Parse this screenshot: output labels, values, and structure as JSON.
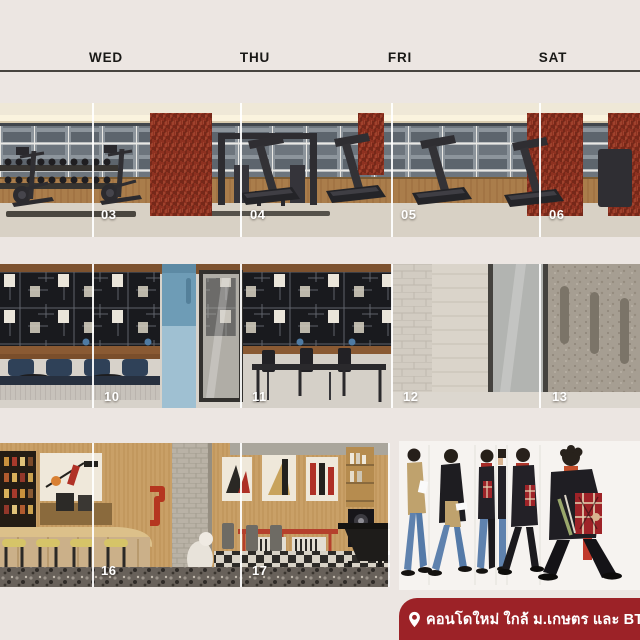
{
  "page": {
    "background_color": "#ece6e2",
    "divider_color": "#ffffff",
    "rule_color": "#47443f"
  },
  "header": {
    "days": [
      "WED",
      "THU",
      "FRI",
      "SAT"
    ]
  },
  "grid": {
    "row1": {
      "scene": "fitness-gym-rendering",
      "dates": [
        "03",
        "04",
        "05",
        "06"
      ]
    },
    "row2": {
      "scene": "co-working-lounge-rendering",
      "dates": [
        "10",
        "11",
        "12",
        "13"
      ]
    },
    "row3": {
      "scene": "cafe-pantry-rendering",
      "dates": [
        "16",
        "17"
      ]
    }
  },
  "illustration": {
    "name": "walking-man-photo-collage",
    "slices": 6
  },
  "banner": {
    "icon": "location-pin-icon",
    "text": "คอนโดใหม่ ใกล้ ม.เกษตร และ BTS",
    "background_color": "#9c2227",
    "text_color": "#ffffff"
  }
}
